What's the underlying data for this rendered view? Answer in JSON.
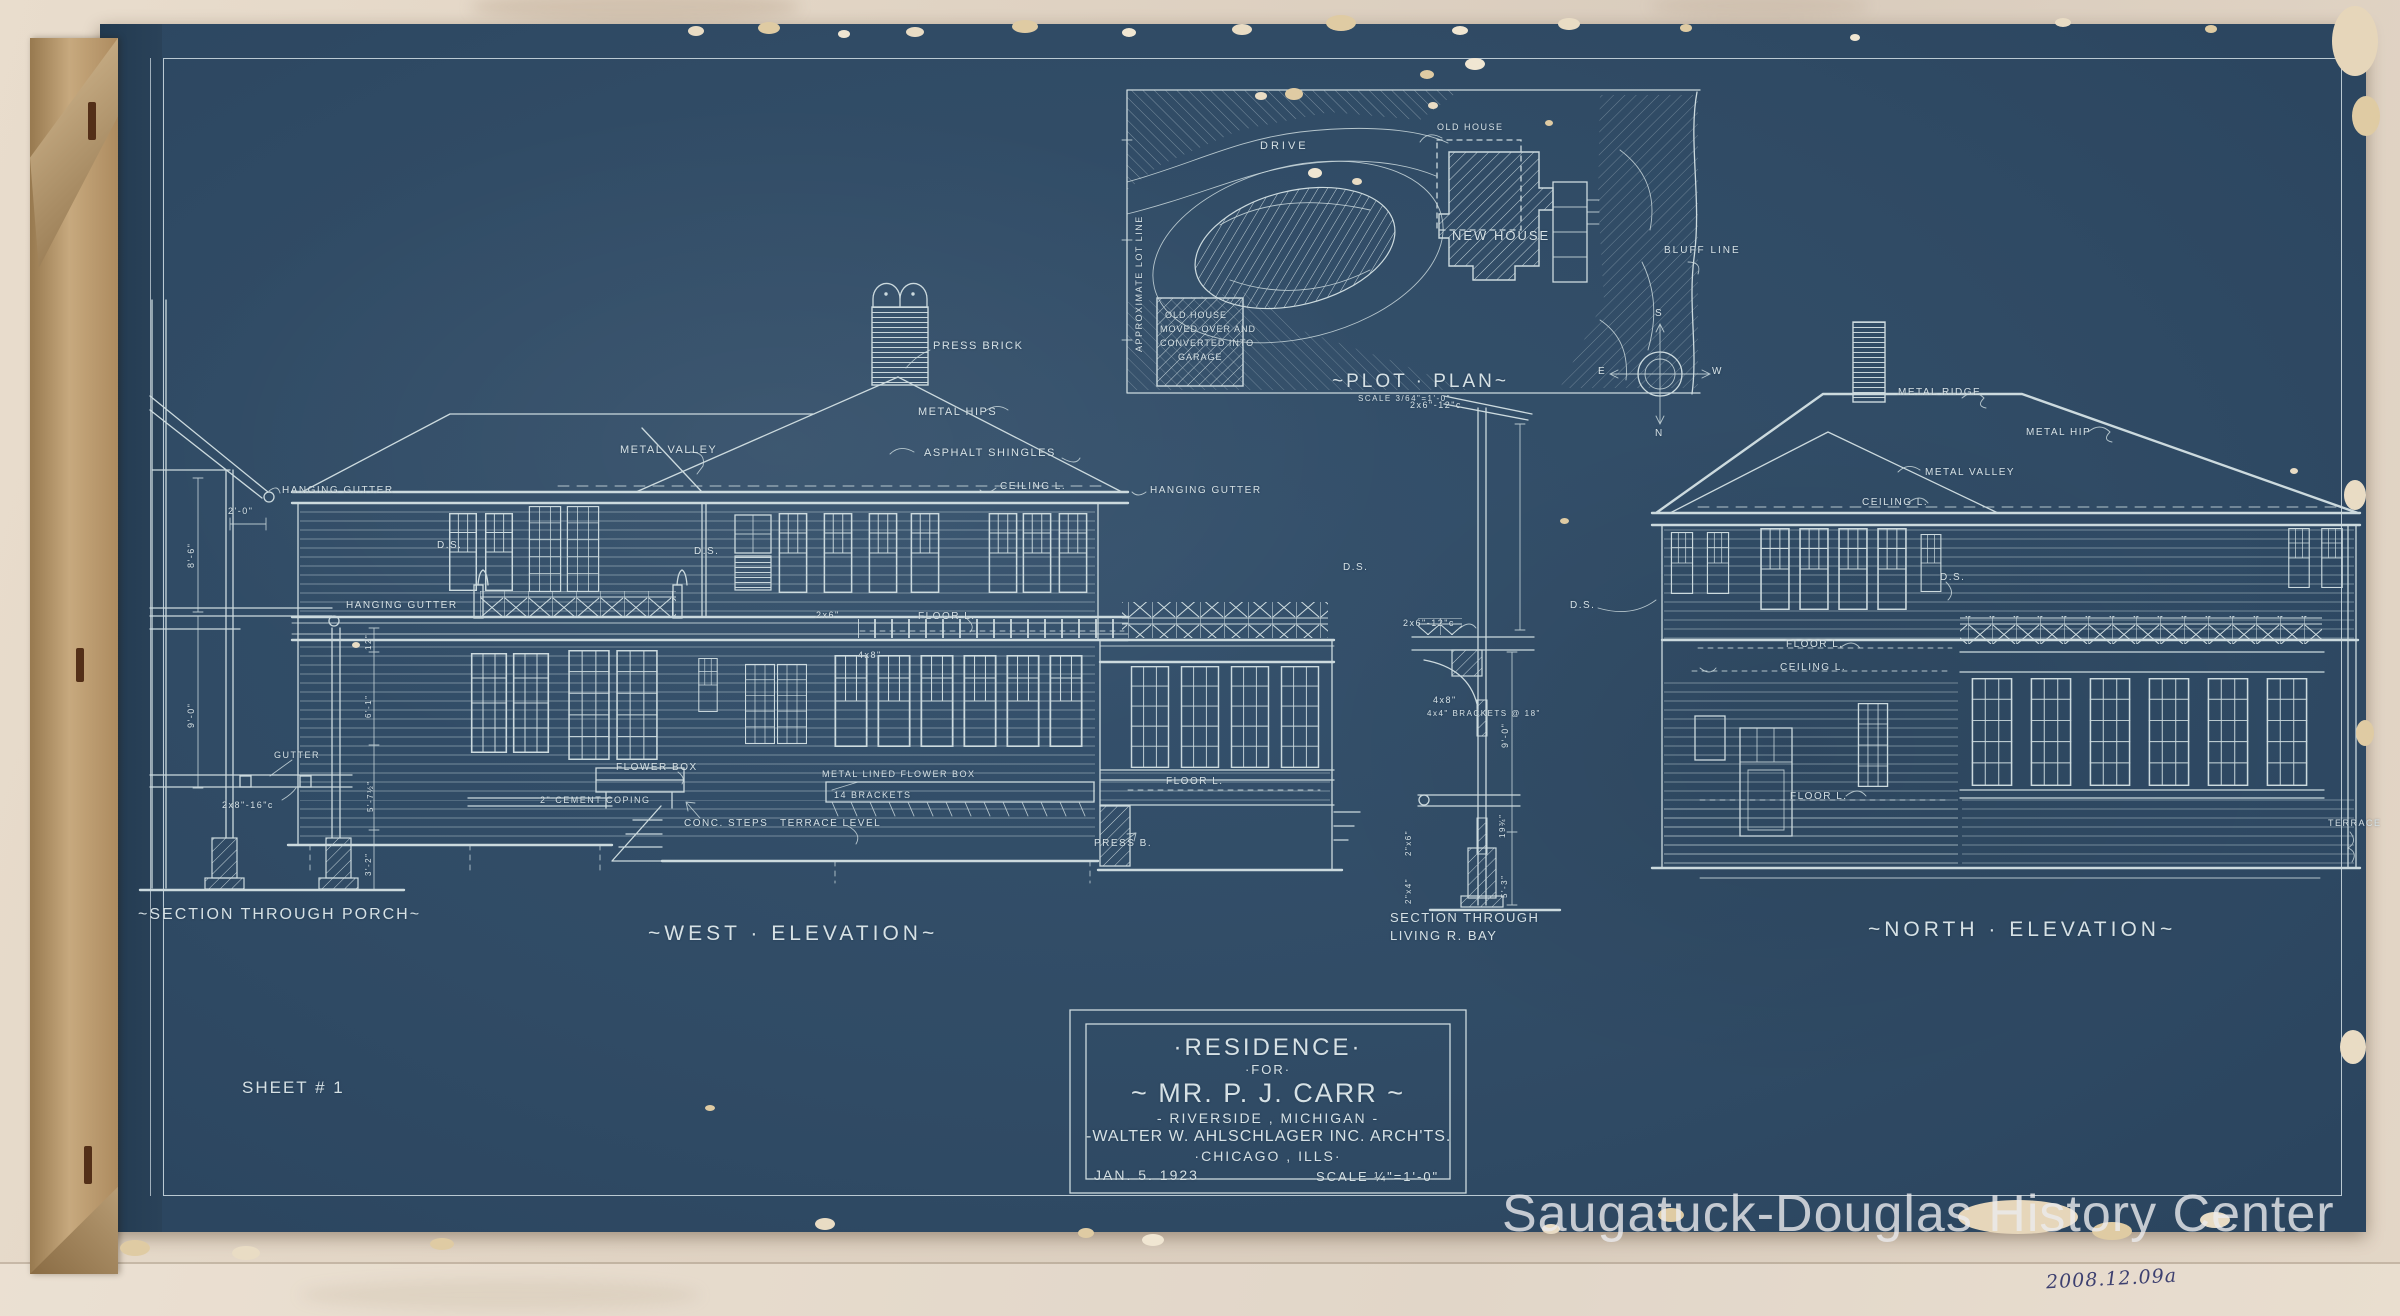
{
  "photo": {
    "watermark": "Saugatuck-Douglas History Center",
    "catalog_number": "2008.12.09a"
  },
  "sheet": {
    "number": "SHEET # 1"
  },
  "title_block": {
    "line1": "·RESIDENCE·",
    "line2": "·FOR·",
    "line3": "~ MR. P. J. CARR ~",
    "line4": "- RIVERSIDE , MICHIGAN -",
    "line5": "-WALTER W. AHLSCHLAGER INC. ARCH'TS.",
    "line6": "·CHICAGO , ILLS·",
    "date": "JAN. 5. 1923",
    "scale": "SCALE ¼\"=1'-0\""
  },
  "plot_plan": {
    "title": "~PLOT · PLAN~",
    "scale": "SCALE 3/64\"=1'-0\"",
    "drive": "DRIVE",
    "lot_line": "APPROXIMATE LOT LINE",
    "old_house": "OLD HOUSE",
    "new_house": "NEW HOUSE",
    "bluff_line": "BLUFF LINE",
    "garage_note_1": "OLD HOUSE",
    "garage_note_2": "MOVED OVER AND",
    "garage_note_3": "CONVERTED INTO",
    "garage_note_4": "GARAGE",
    "compass": {
      "n": "N",
      "s": "S",
      "e": "E",
      "w": "W"
    }
  },
  "west_elevation": {
    "caption": "~WEST · ELEVATION~",
    "press_brick": "PRESS BRICK",
    "metal_hips": "METAL HIPS",
    "metal_valley": "METAL VALLEY",
    "asphalt_shingles": "ASPHALT SHINGLES",
    "ceiling_l": "CEILING L.",
    "hanging_gutter": "HANGING GUTTER",
    "ds": "D.S.",
    "ds2": "D.S.",
    "ds3": "D.S.",
    "joist": "2x6\"",
    "floor_l": "FLOOR L.",
    "beam": "4x8\"",
    "flower_box": "FLOWER BOX",
    "cement_coping": "2\" CEMENT COPING",
    "conc_steps": "CONC. STEPS",
    "terrace_level": "TERRACE LEVEL",
    "metal_lined_flower_box": "METAL LINED FLOWER BOX",
    "brackets": "14 BRACKETS",
    "floor_l2": "FLOOR L.",
    "press_b": "PRESS B."
  },
  "north_elevation": {
    "caption": "~NORTH · ELEVATION~",
    "metal_ridge": "METAL RIDGE",
    "metal_hip": "METAL HIP",
    "metal_valley": "METAL VALLEY",
    "ceiling_l": "CEILING L.",
    "ds": "D.S.",
    "ds2": "D.S.",
    "floor_l": "FLOOR L.",
    "ceiling_l2": "CEILING L.",
    "floor_l2": "FLOOR L.",
    "terrace": "TERRACE"
  },
  "section_porch": {
    "caption": "~SECTION THROUGH PORCH~",
    "hanging_gutter": "HANGING GUTTER",
    "hanging_gutter2": "HANGING GUTTER",
    "gutter": "GUTTER",
    "joists": "2x8\"-16\"c",
    "dim_2_0": "2'-0\"",
    "dim_8_6": "8'-6\"",
    "dim_9_0": "9'-0\"",
    "dim_12": "12\"",
    "dim_6_1": "6'-1\"",
    "dim_5_7": "5'-7½\"",
    "dim_3_2": "3'-2\""
  },
  "section_bay": {
    "caption_1": "SECTION THROUGH",
    "caption_2": "LIVING R. BAY",
    "rafters_upper": "2x6\"-12\"c",
    "rafters": "2x6\"-12\"c",
    "beam": "4x8\"",
    "brackets": "4x4\" BRACKETS @ 18\"",
    "dim_9_0": "9'-0\"",
    "dim_19": "19¾\"",
    "dim_5_3": "5'-3\"",
    "stud1": "2\"x6\"",
    "stud2": "2\"x4\""
  }
}
